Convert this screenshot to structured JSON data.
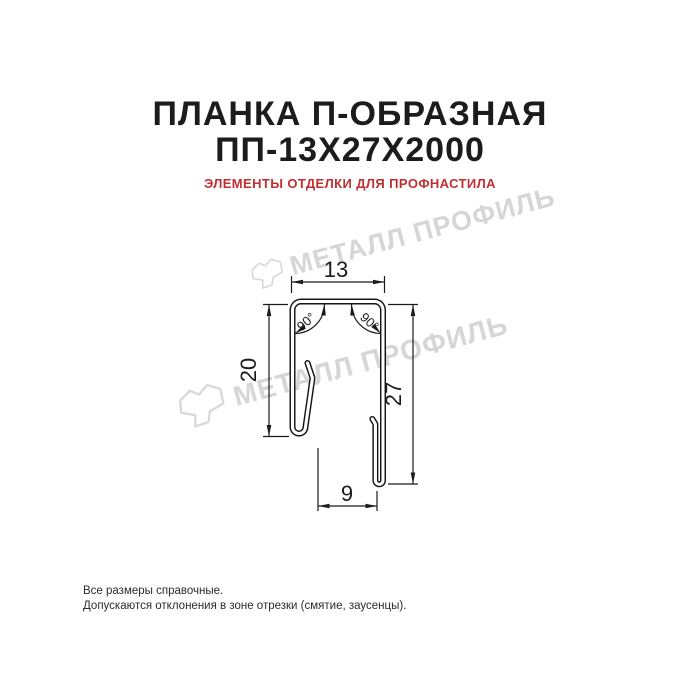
{
  "header": {
    "title_line1": "ПЛАНКА П-ОБРАЗНАЯ",
    "title_line2": "ПП-13Х27Х2000",
    "subtitle": "ЭЛЕМЕНТЫ ОТДЕЛКИ ДЛЯ ПРОФНАСТИЛА"
  },
  "drawing": {
    "type": "profile-cross-section",
    "dimensions": {
      "top_width": "13",
      "left_height": "20",
      "right_height": "27",
      "bottom_width": "9",
      "angle_left": "90°",
      "angle_right": "90°"
    }
  },
  "watermark": {
    "text": "МЕТАЛЛ ПРОФИЛЬ"
  },
  "footer": {
    "line1": "Все размеры справочные.",
    "line2": "Допускаются отклонения в зоне отрезки (смятие, заусенцы)."
  },
  "colors": {
    "title": "#1c1c1c",
    "subtitle_red": "#c22f33",
    "drawing_line": "#1b1b1b",
    "watermark_gray": "#d6d6d6",
    "background": "#ffffff"
  }
}
